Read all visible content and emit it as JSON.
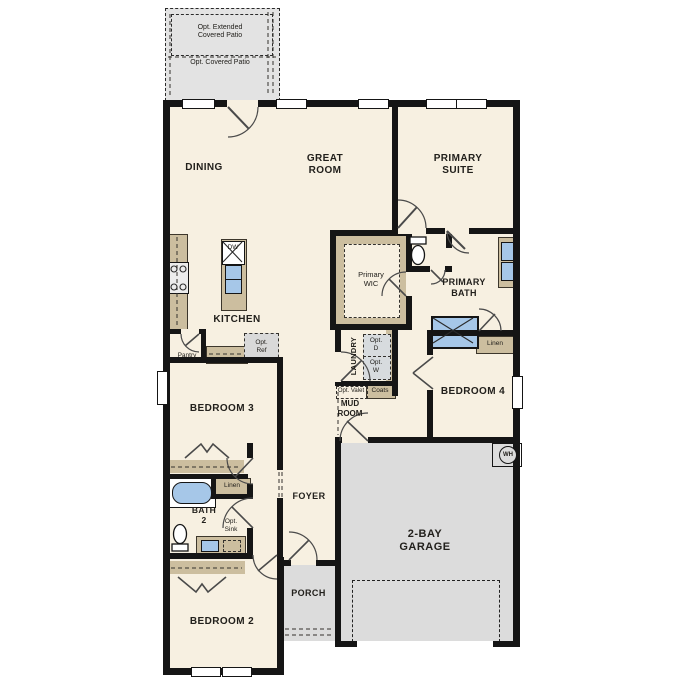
{
  "document": {
    "type": "single-story floor plan"
  },
  "colors": {
    "floor": "#f7f0e1",
    "wall": "#151515",
    "counter_tan": "#ccbe9f",
    "fixture_blue": "#a6c7e8",
    "garage_gray": "#dcdcdc",
    "patio_gray": "#e3e3e3",
    "optional_gray": "#d7dbde",
    "label_text": "#22201c"
  },
  "patio": {
    "extended_label": "Opt. Extended\nCovered Patio",
    "covered_label": "Opt. Covered Patio"
  },
  "rooms": {
    "dining": "DINING",
    "great_room": "GREAT\nROOM",
    "primary_suite": "PRIMARY\nSUITE",
    "kitchen": "KITCHEN",
    "primary_wic": "Primary\nWIC",
    "primary_bath": "PRIMARY\nBATH",
    "laundry": "LAUNDRY",
    "mud_room": "MUD\nROOM",
    "bedroom_4": "BEDROOM 4",
    "bedroom_3": "BEDROOM 3",
    "foyer": "FOYER",
    "bath_2": "BATH\n2",
    "bedroom_2": "BEDROOM 2",
    "garage": "2-BAY\nGARAGE",
    "porch": "PORCH"
  },
  "fixtures": {
    "dishwasher": "DW",
    "pantry": "Pantry",
    "opt_ref": "Opt.\nRef",
    "opt_dryer": "Opt.\nD",
    "opt_washer": "Opt.\nW",
    "opt_valet": "Opt. Valet",
    "coats": "Coats",
    "linen_hall": "Linen",
    "linen_bed3": "Linen",
    "opt_sink": "Opt.\nSink",
    "water_heater": "WH"
  }
}
